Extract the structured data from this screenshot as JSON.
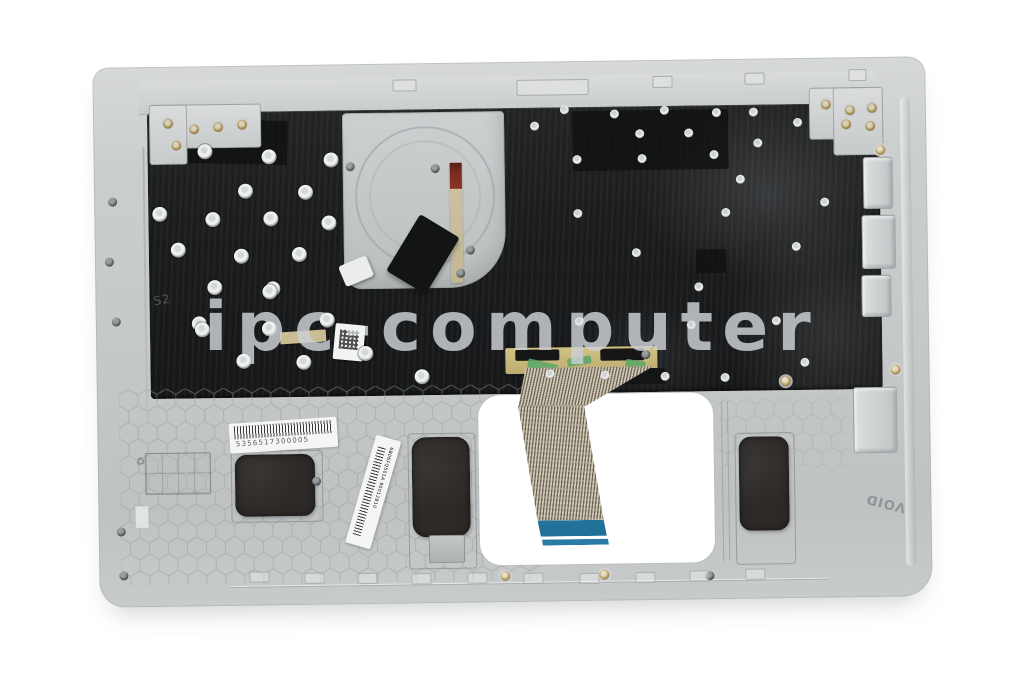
{
  "image": {
    "type": "product-photo",
    "subject": "laptop topcase with keyboard, rear underside view",
    "watermark": "ipc-computer"
  },
  "labels": {
    "barcode_number": "5356517300005",
    "diagonal_label": "6B06FQ501A  90012B10",
    "void_mark": "VOID",
    "plate_etch": "S2",
    "flex_print": "o|O2 ----"
  },
  "colors": {
    "background": "#ffffff",
    "palmrest_silver": "#c5c8c9",
    "keyboard_plate_black": "#1b1c1d",
    "ribbon_blue_tip": "#2a7ca6",
    "kapton_tape": "#c9b97c",
    "tape_green": "#58a868",
    "flex_red": "#7d2d20",
    "screw_gold": "#a98f55"
  }
}
